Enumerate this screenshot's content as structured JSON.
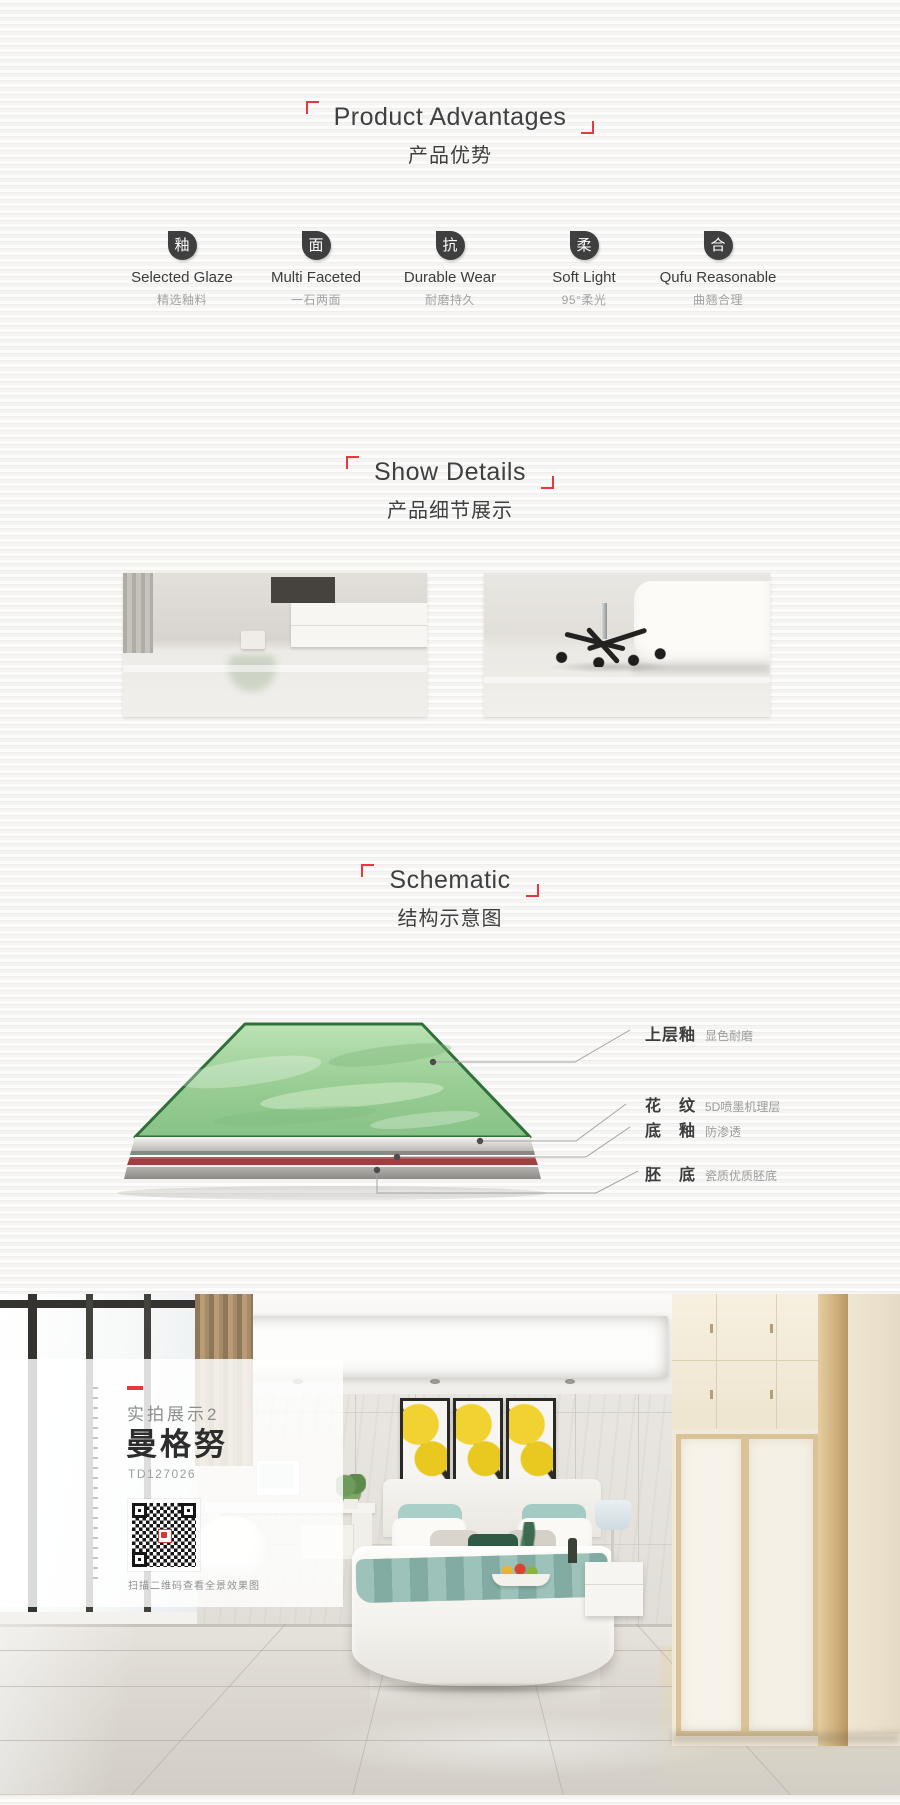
{
  "colors": {
    "accent_red": "#e8383d",
    "tile_green_fill": "#93cb90",
    "tile_green_border": "#2f7038",
    "under_glaze_red": "#9c4141",
    "base_gray": "#a3a19e"
  },
  "advantages": {
    "title": "Product Advantages",
    "subtitle": "产品优势",
    "items": [
      {
        "icon": "釉",
        "label": "Selected Glaze",
        "sublabel": "精选釉料"
      },
      {
        "icon": "面",
        "label": "Multi Faceted",
        "sublabel": "一石两面"
      },
      {
        "icon": "抗",
        "label": "Durable Wear",
        "sublabel": "耐磨持久"
      },
      {
        "icon": "柔",
        "label": "Soft Light",
        "sublabel": "95°柔光"
      },
      {
        "icon": "合",
        "label": "Qufu Reasonable",
        "sublabel": "曲翘合理"
      }
    ]
  },
  "details": {
    "title": "Show Details",
    "subtitle": "产品细节展示",
    "photos": [
      {
        "name": "living-room-glossy-tile-floor"
      },
      {
        "name": "bedroom-chair-glossy-tile-floor"
      }
    ]
  },
  "schematic": {
    "title": "Schematic",
    "subtitle": "结构示意图",
    "layers": [
      {
        "name": "上层釉",
        "desc": "显色耐磨"
      },
      {
        "name": "花　纹",
        "desc": "5D喷墨机理层"
      },
      {
        "name": "底　釉",
        "desc": "防渗透"
      },
      {
        "name": "胚　底",
        "desc": "瓷质优质胚底"
      }
    ]
  },
  "showcase": {
    "tag": "实拍展示2",
    "product_name": "曼格努",
    "product_code": "TD127026",
    "qr_caption": "扫描二维码查看全景效果图",
    "qr_icon": "qr-code"
  }
}
